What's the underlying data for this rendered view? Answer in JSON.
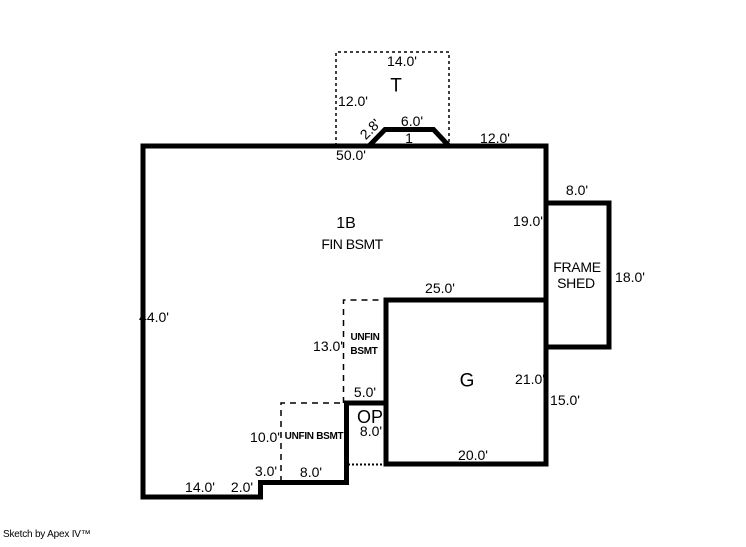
{
  "sketch": {
    "credit": "Sketch by Apex IV™",
    "rooms": {
      "t_area": "T",
      "main_area": "1B",
      "main_area_sub": "FIN BSMT",
      "garage": "G",
      "open_porch": "OP",
      "shed_line1": "FRAME",
      "shed_line2": "SHED",
      "unfin_upper_line1": "UNFIN",
      "unfin_upper_line2": "BSMT",
      "unfin_lower": "UNFIN BSMT",
      "bay_count": "1"
    },
    "dimensions": {
      "t_top": "14.0'",
      "t_left": "12.0'",
      "bay_top": "6.0'",
      "bay_side": "2.8'",
      "top_right": "12.0'",
      "top_total": "50.0'",
      "shed_top": "8.0'",
      "right_upper": "19.0'",
      "shed_right": "18.0'",
      "garage_top": "25.0'",
      "left_total": "44.0'",
      "unfin_upper_height": "13.0'",
      "garage_right": "21.0'",
      "unfin_upper_width": "5.0'",
      "right_lower": "15.0'",
      "porch_height": "8.0'",
      "unfin_lower_height": "10.0'",
      "garage_bottom": "20.0'",
      "step_top": "3.0'",
      "unfin_lower_width": "8.0'",
      "bottom_left": "14.0'",
      "step_side": "2.0'"
    },
    "colors": {
      "line": "#000000",
      "background": "#ffffff"
    }
  }
}
